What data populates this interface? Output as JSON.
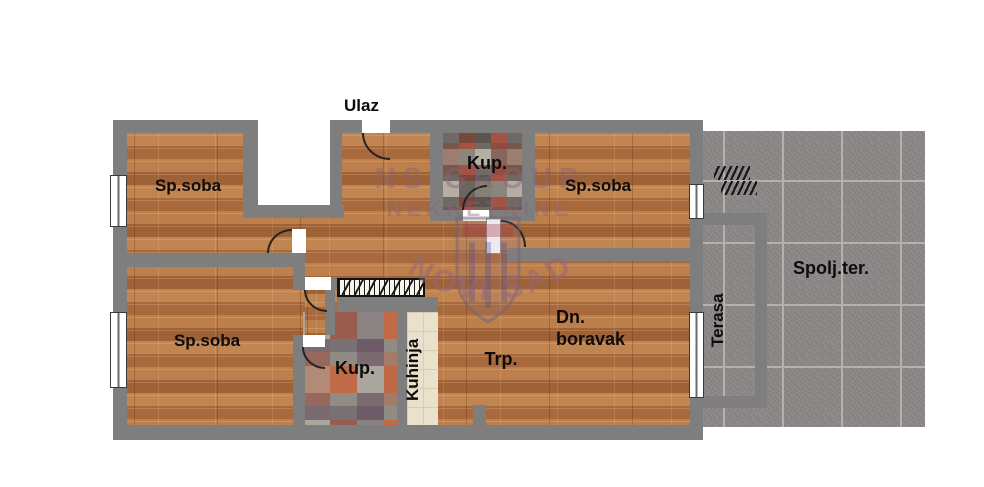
{
  "title": "Apartment floor plan",
  "entrance": {
    "label": "Ulaz"
  },
  "rooms": [
    {
      "id": "sp-soba-top-left",
      "label": "Sp.soba"
    },
    {
      "id": "kup-top",
      "label": "Kup."
    },
    {
      "id": "sp-soba-top-right",
      "label": "Sp.soba"
    },
    {
      "id": "sp-soba-bottom-left",
      "label": "Sp.soba"
    },
    {
      "id": "kup-bottom",
      "label": "Kup."
    },
    {
      "id": "kuhinja",
      "label": "Kuhinja"
    },
    {
      "id": "trpezarija",
      "label": "Trp."
    },
    {
      "id": "dnevni-boravak",
      "label_line1": "Dn.",
      "label_line2": "boravak"
    },
    {
      "id": "terasa",
      "label": "Terasa"
    },
    {
      "id": "spoljna-terasa",
      "label": "Spolj.ter."
    }
  ],
  "watermark": {
    "line1": "NS GROUP",
    "line2": "NEKRETNINE",
    "arc_text": "NOVI SAD"
  },
  "colors": {
    "wall": "#7e7e7e",
    "wood": "#b5794a",
    "tile_outdoor": "#8d8888",
    "tile_kitchen": "#e9e1cb",
    "bath_tile_accent": "#a35243",
    "watermark_ink": "#8a6478",
    "label_ink": "#0c0c0c"
  }
}
